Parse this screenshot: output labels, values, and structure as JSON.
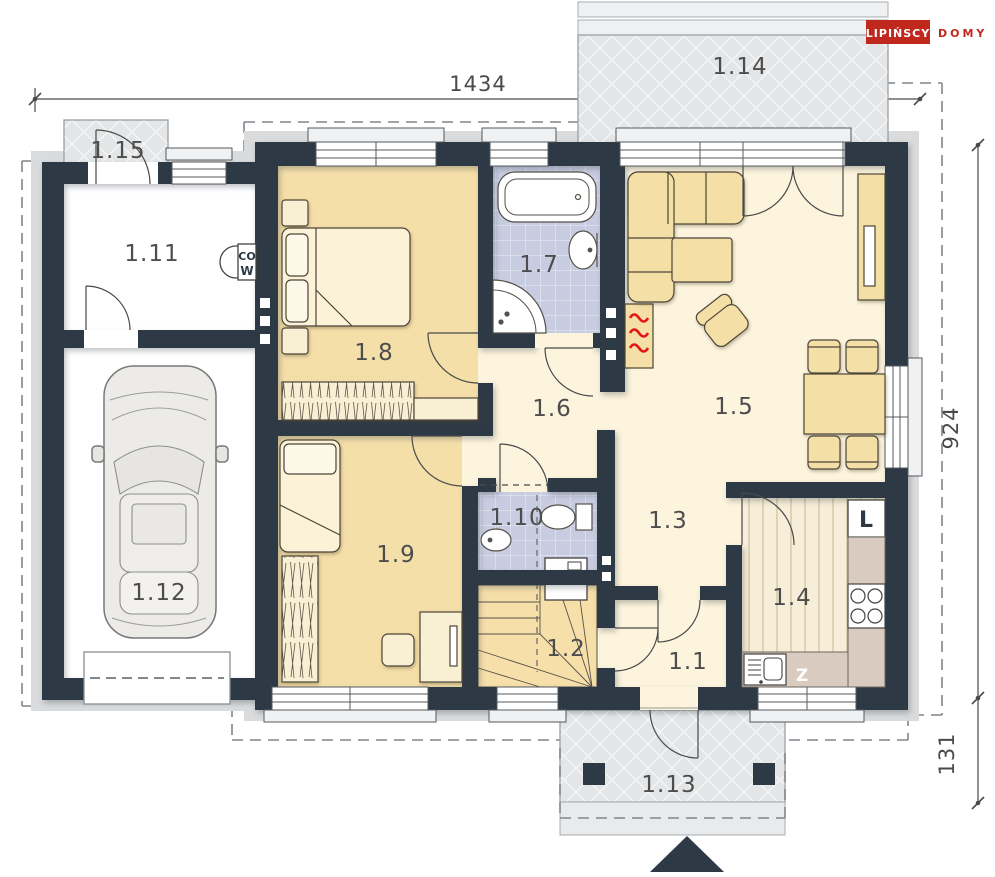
{
  "brand": {
    "name": "LIPIŃSCY",
    "suffix": "DOMY"
  },
  "dimensions": {
    "width_total": "1434",
    "depth_main": "924",
    "porch_depth": "131"
  },
  "rooms": {
    "r1_1": "1.1",
    "r1_2": "1.2",
    "r1_3": "1.3",
    "r1_4": "1.4",
    "r1_5": "1.5",
    "r1_6": "1.6",
    "r1_7": "1.7",
    "r1_8": "1.8",
    "r1_9": "1.9",
    "r1_10": "1.10",
    "r1_11": "1.11",
    "r1_12": "1.12",
    "r1_13": "1.13",
    "r1_14": "1.14",
    "r1_15": "1.15"
  },
  "appliances": {
    "fridge": "L",
    "dishwasher": "Z",
    "boiler_top": "CO",
    "boiler_bottom": "W"
  }
}
